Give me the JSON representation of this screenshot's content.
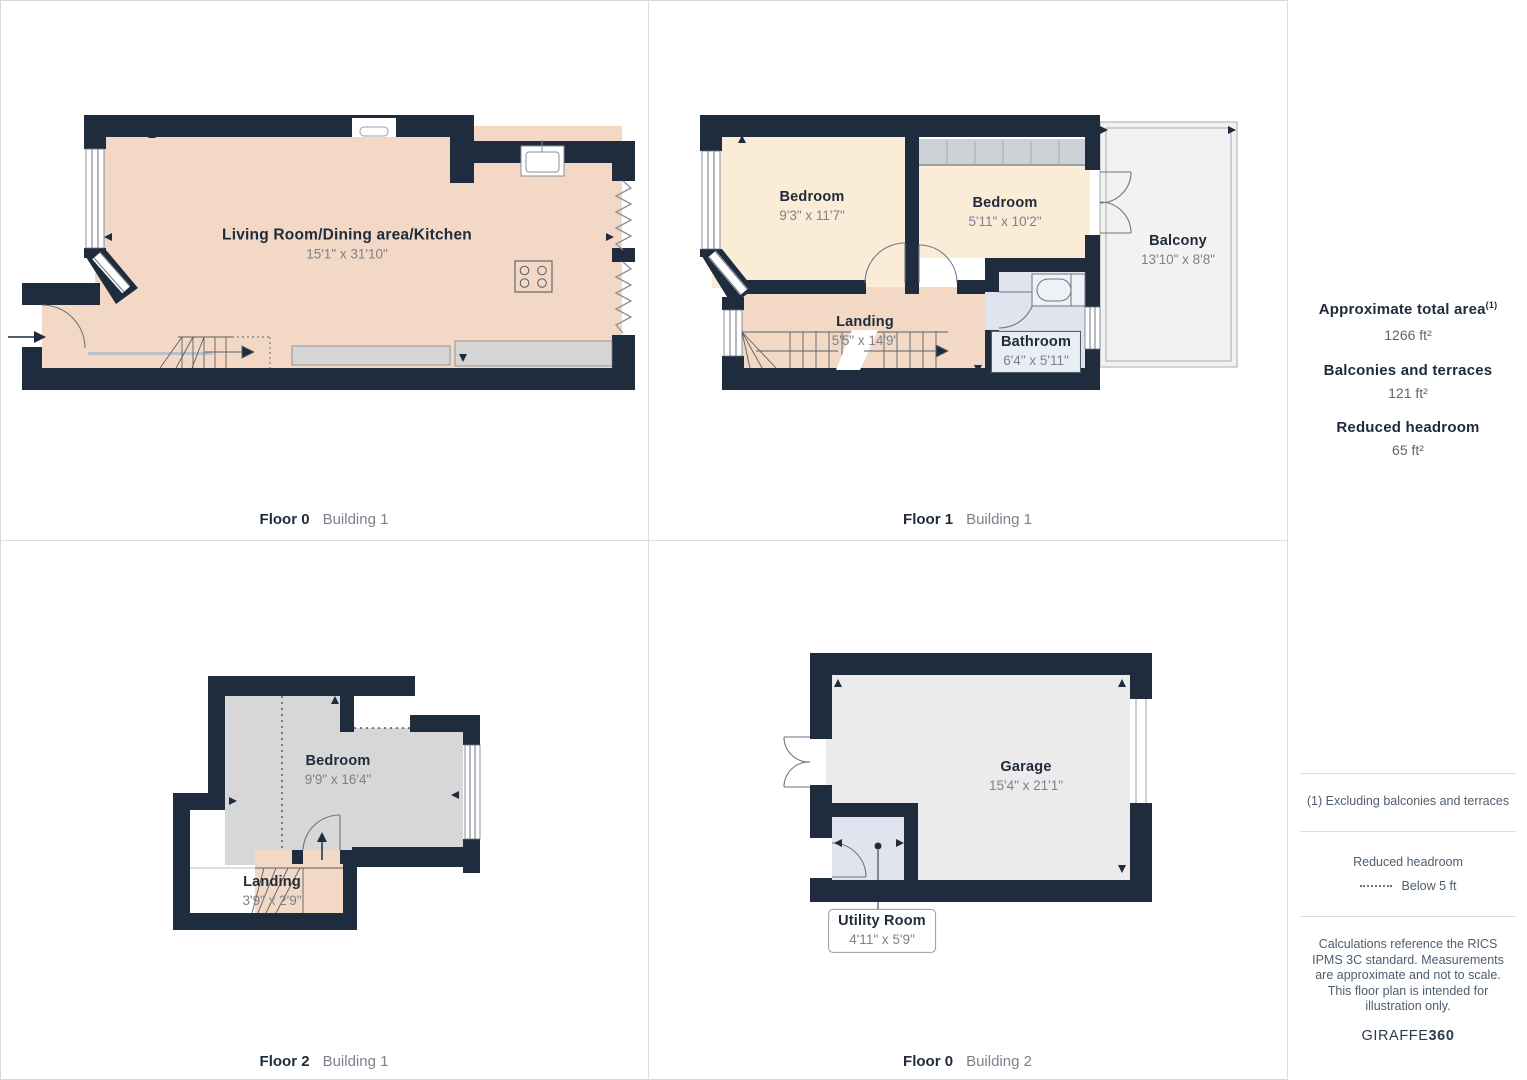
{
  "plans": {
    "f0b1": {
      "caption": {
        "floor": "Floor 0",
        "building": "Building 1"
      },
      "rooms": {
        "living": {
          "name": "Living Room/Dining area/Kitchen",
          "dims": "15'1\" x 31'10\""
        }
      }
    },
    "f1b1": {
      "caption": {
        "floor": "Floor 1",
        "building": "Building 1"
      },
      "rooms": {
        "bedroom1": {
          "name": "Bedroom",
          "dims": "9'3\" x 11'7\""
        },
        "bedroom2": {
          "name": "Bedroom",
          "dims": "5'11\" x 10'2\""
        },
        "balcony": {
          "name": "Balcony",
          "dims": "13'10\" x 8'8\""
        },
        "landing": {
          "name": "Landing",
          "dims": "5'5\" x 14'9\""
        },
        "bathroom": {
          "name": "Bathroom",
          "dims": "6'4\" x 5'11\""
        }
      }
    },
    "f2b1": {
      "caption": {
        "floor": "Floor 2",
        "building": "Building 1"
      },
      "rooms": {
        "bedroom": {
          "name": "Bedroom",
          "dims": "9'9\" x 16'4\""
        },
        "landing": {
          "name": "Landing",
          "dims": "3'9\" x 2'9\""
        }
      }
    },
    "f0b2": {
      "caption": {
        "floor": "Floor 0",
        "building": "Building 2"
      },
      "rooms": {
        "garage": {
          "name": "Garage",
          "dims": "15'4\" x 21'1\""
        },
        "utility": {
          "name": "Utility Room",
          "dims": "4'11\" x 5'9\""
        }
      }
    }
  },
  "sidebar": {
    "total_area": {
      "label": "Approximate total area",
      "sup": "(1)",
      "value": "1266 ft²"
    },
    "balconies": {
      "label": "Balconies and terraces",
      "value": "121 ft²"
    },
    "reduced": {
      "label": "Reduced headroom",
      "value": "65 ft²"
    },
    "footnote": "(1) Excluding balconies and terraces",
    "legend": {
      "title": "Reduced headroom",
      "item": "Below 5 ft"
    },
    "disclaimer": "Calculations reference the RICS IPMS 3C standard. Measurements are approximate and not to scale. This floor plan is intended for illustration only.",
    "brand": {
      "name": "GIRAFFE",
      "bold": "360"
    }
  },
  "colors": {
    "wall": "#1f2c3d",
    "floor_warm": "#f2d8c5",
    "floor_cream": "#fbecd8",
    "floor_gray": "#d7d7d7",
    "floor_light": "#ebebeb",
    "floor_blue": "#dfe4ee",
    "balcony": "#f2f2f2"
  }
}
